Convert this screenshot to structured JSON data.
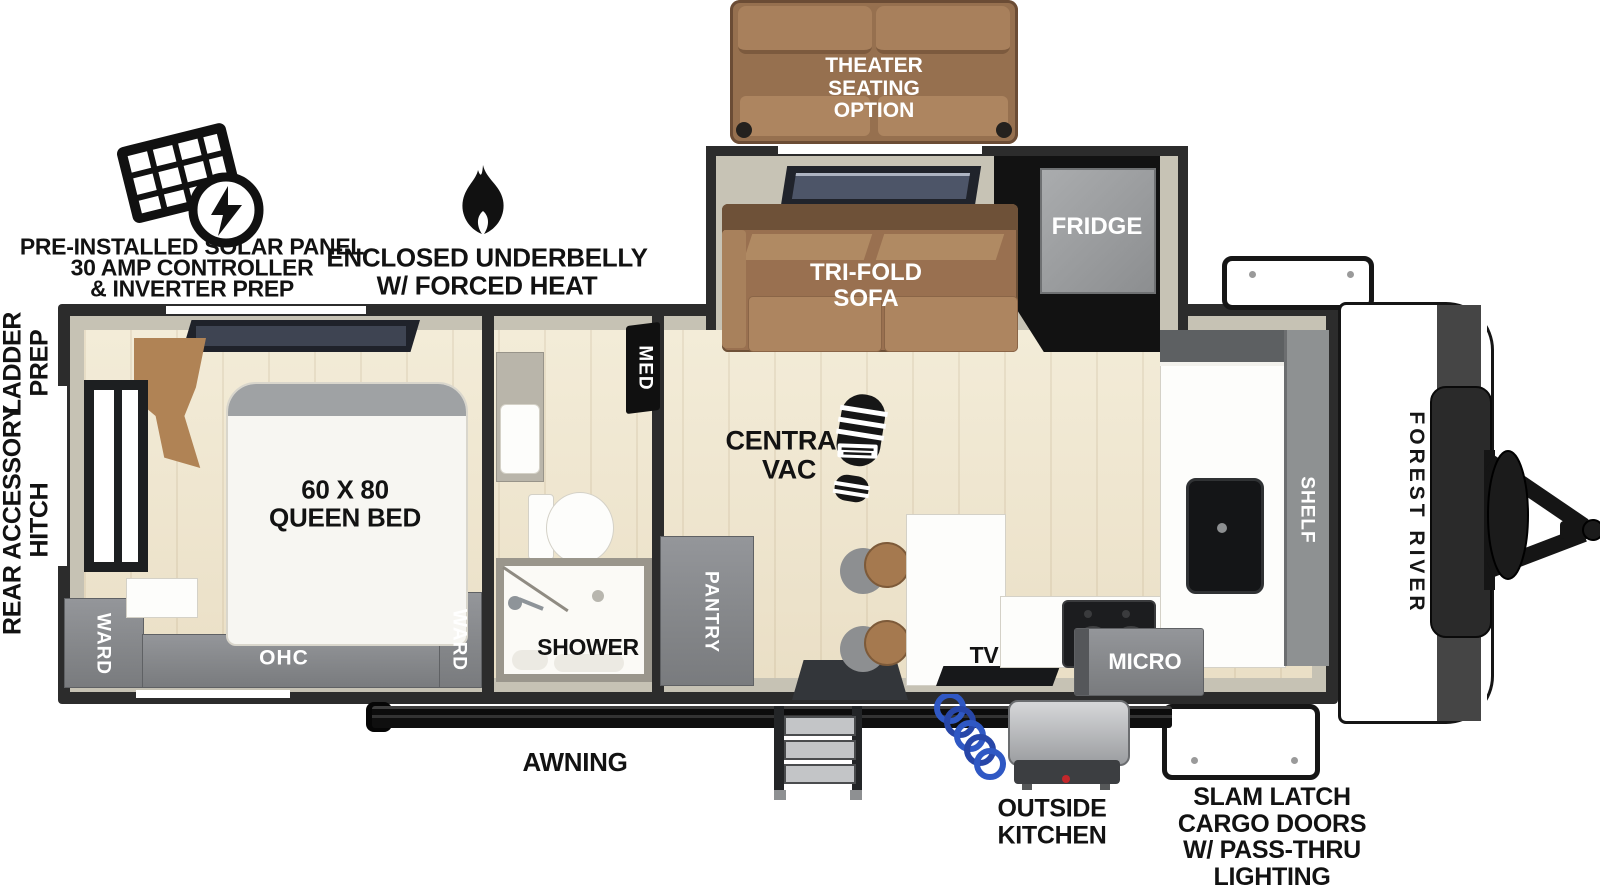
{
  "title": "Forest River travel trailer floor plan",
  "brand": "FOREST RIVER",
  "features": {
    "solar": {
      "line1": "PRE-INSTALLED SOLAR PANEL",
      "line2": "30 AMP CONTROLLER",
      "line3": "& INVERTER PREP",
      "icon": "solar-panel-icon"
    },
    "underbelly": {
      "line1": "ENCLOSED UNDERBELLY",
      "line2": "W/ FORCED HEAT",
      "icon": "flame-icon"
    },
    "ladder": {
      "line1": "LADDER",
      "line2": "PREP"
    },
    "rear_hitch": {
      "line1": "REAR ACCESSORY",
      "line2": "HITCH"
    },
    "awning": "AWNING",
    "outside_kitchen": {
      "line1": "OUTSIDE",
      "line2": "KITCHEN"
    },
    "cargo_doors": {
      "line1": "SLAM LATCH",
      "line2": "CARGO DOORS",
      "line3": "W/ PASS-THRU",
      "line4": "LIGHTING"
    }
  },
  "furniture": {
    "theater": {
      "line1": "THEATER",
      "line2": "SEATING",
      "line3": "OPTION"
    },
    "trifold": {
      "line1": "TRI-FOLD",
      "line2": "SOFA"
    },
    "fridge": "FRIDGE",
    "central_vac": {
      "line1": "CENTRAL",
      "line2": "VAC"
    },
    "pantry": "PANTRY",
    "shelf": "SHELF",
    "tv": "TV",
    "micro": "MICRO",
    "med": "MED",
    "shower": "SHOWER",
    "bed": {
      "line1": "60 X 80",
      "line2": "QUEEN BED"
    },
    "ward_left": "WARD",
    "ward_right": "WARD",
    "ohc": "OHC"
  },
  "colors": {
    "floor_wood": "#EFE7D2",
    "wall_face": "#C6C2B4",
    "wall_outline": "#2C2C2C",
    "cabinet_gray": "#87898B",
    "sofa_brown": "#9B7354",
    "counter_white": "#FFFFFF",
    "fixture_black": "#1A1A1A",
    "hose_blue": "#2F58C4",
    "knob_red": "#C3272B"
  }
}
